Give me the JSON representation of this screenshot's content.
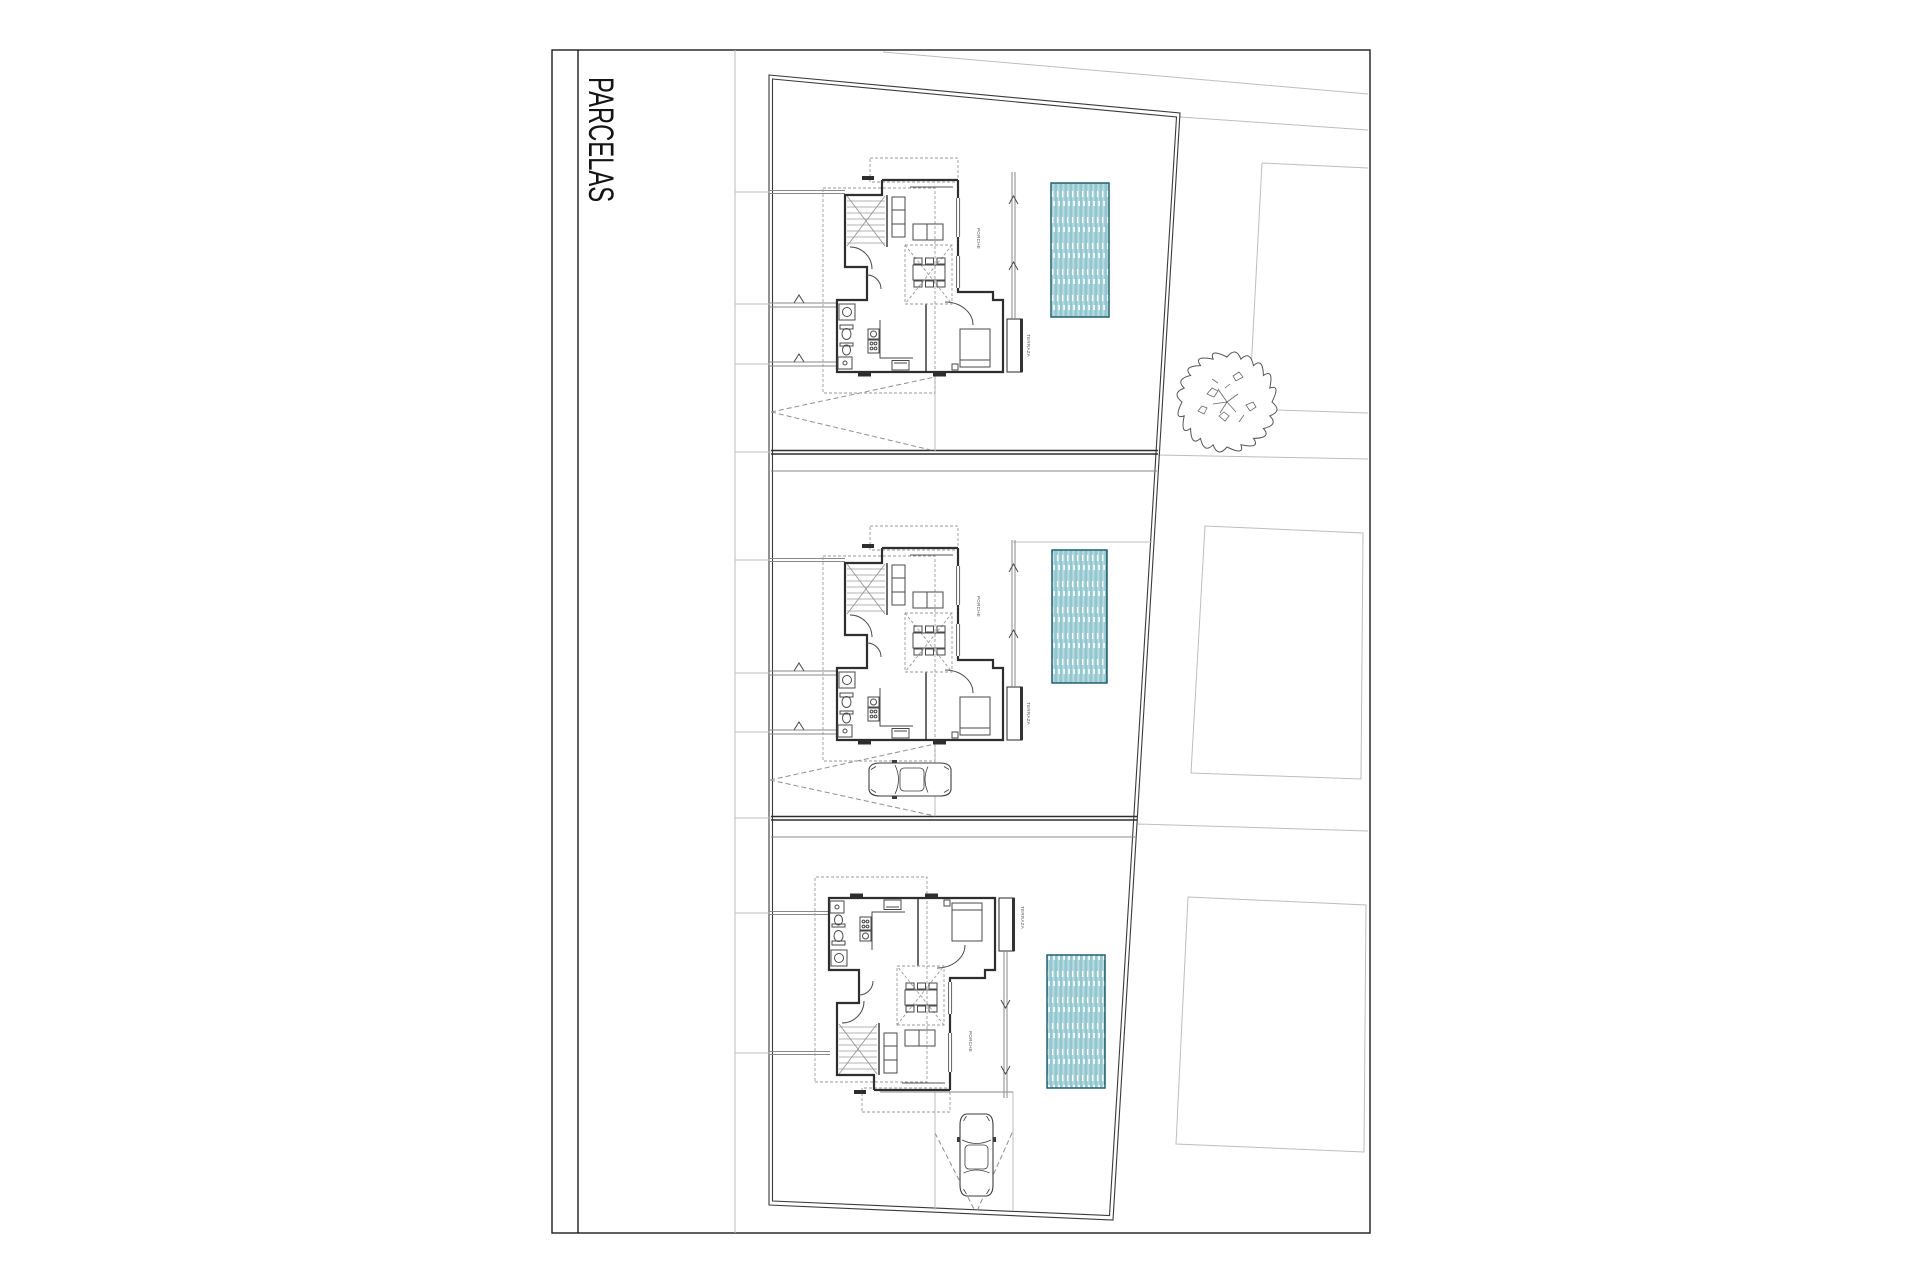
{
  "sheet": {
    "title": "PARCELAS"
  },
  "plan": {
    "labels": {
      "porch": "PORCHE",
      "terrace": "TERRAZA"
    },
    "parcels": [
      {
        "id": "parcel-1",
        "house": true,
        "pool": true,
        "car": false,
        "tree_adjacent": true
      },
      {
        "id": "parcel-2",
        "house": true,
        "pool": true,
        "car": true
      },
      {
        "id": "parcel-3",
        "house": true,
        "pool": true,
        "car": true
      }
    ]
  },
  "theme": {
    "paper": "#ffffff",
    "frame": "#1c1c1c",
    "wall": "#2e2e2e",
    "mid": "#8a8a8a",
    "light": "#bdbdbd",
    "dashline": "#8f8f8f",
    "poolBorder": "#23606e",
    "poolFill": "#d9edf0",
    "poolStripeA": "#4f9fae",
    "poolStripeB": "#9fd0d8"
  }
}
